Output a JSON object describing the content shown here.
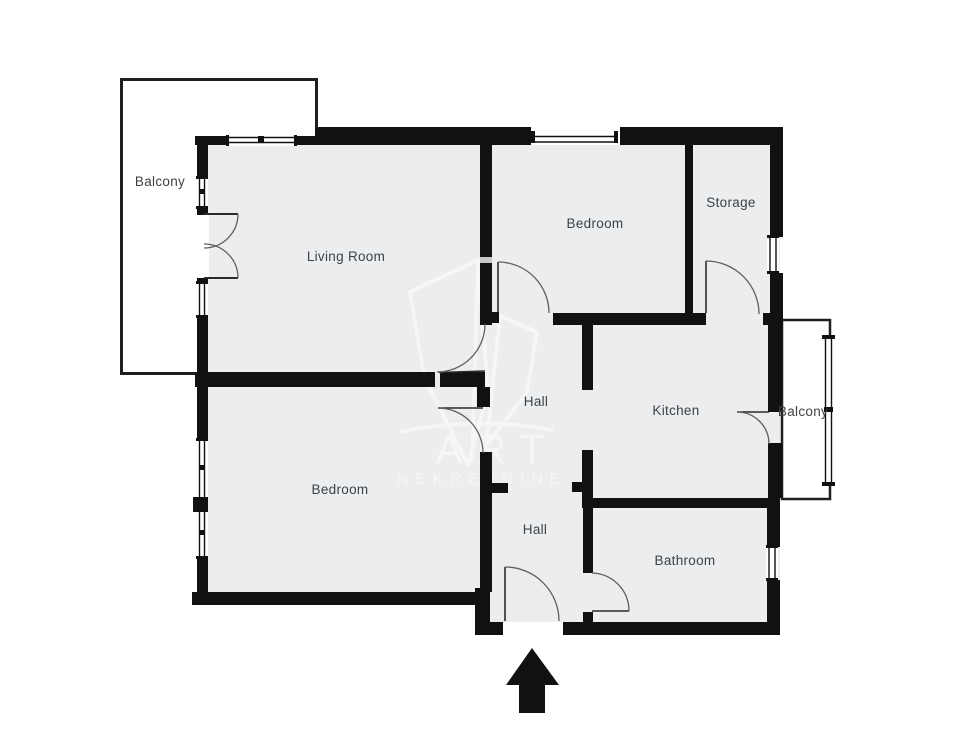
{
  "title": "Apartment floor plan",
  "colors": {
    "background": "#ffffff",
    "floor": "#ebedee",
    "wall": "#111111",
    "wall_notch": "#c8c8cb",
    "door_arc": "#5f5f5f",
    "door_leaf": "#2b2b2b",
    "balcony_border": "#1f1f1f",
    "label": "#3e4246",
    "watermark": "#ffffff"
  },
  "rooms": {
    "balcony_left": {
      "label": "Balcony"
    },
    "living_room": {
      "label": "Living Room"
    },
    "bedroom_top": {
      "label": "Bedroom"
    },
    "storage": {
      "label": "Storage"
    },
    "hall_upper": {
      "label": "Hall"
    },
    "kitchen": {
      "label": "Kitchen"
    },
    "balcony_right": {
      "label": "Balcony"
    },
    "bedroom_bottom": {
      "label": "Bedroom"
    },
    "hall_lower": {
      "label": "Hall"
    },
    "bathroom": {
      "label": "Bathroom"
    }
  },
  "watermark": {
    "line1": "ART",
    "line2": "NEKRETNINE"
  }
}
